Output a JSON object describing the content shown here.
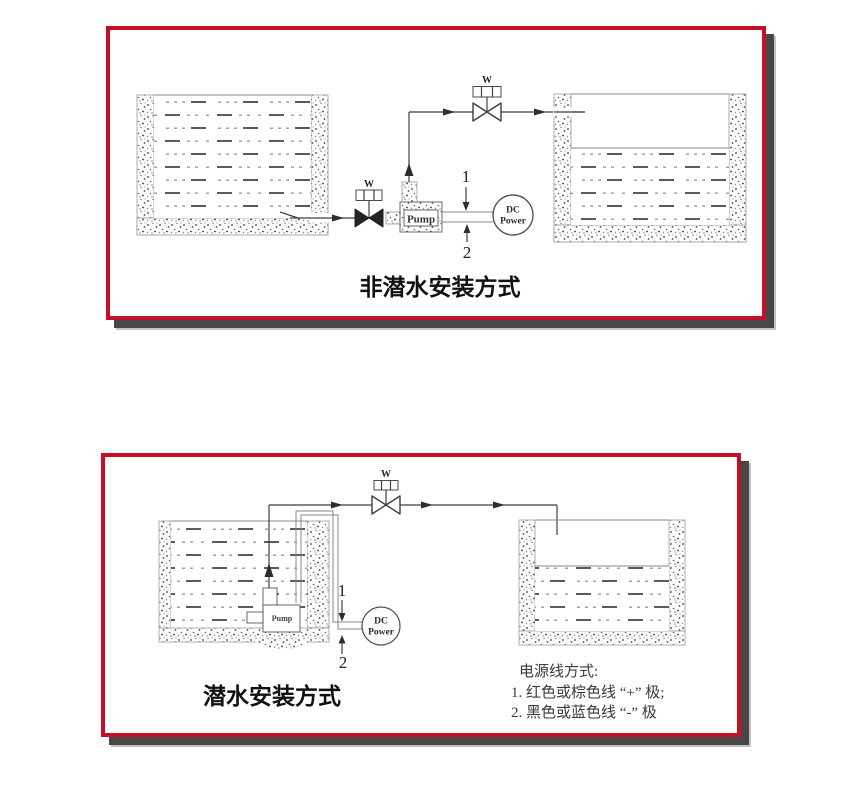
{
  "colors": {
    "frame_red": "#c40f26",
    "frame_shadow": "#4a4547",
    "line": "#3f3f3f"
  },
  "panels": {
    "top": {
      "title": "非潜水安装方式",
      "valve_inlet_label": "W",
      "valve_outlet_label": "W",
      "pump_label": "Pump",
      "dc_power_line1": "DC",
      "dc_power_line2": "Power",
      "wire_positive_label": "1",
      "wire_negative_label": "2"
    },
    "bottom": {
      "title": "潜水安装方式",
      "valve_label": "W",
      "pump_label": "Pump",
      "dc_power_line1": "DC",
      "dc_power_line2": "Power",
      "wire_positive_label": "1",
      "wire_negative_label": "2",
      "notes": {
        "heading": "电源线方式:",
        "item1": "1. 红色或棕色线 “+” 极;",
        "item2": "2. 黑色或蓝色线 “-” 极"
      }
    }
  }
}
